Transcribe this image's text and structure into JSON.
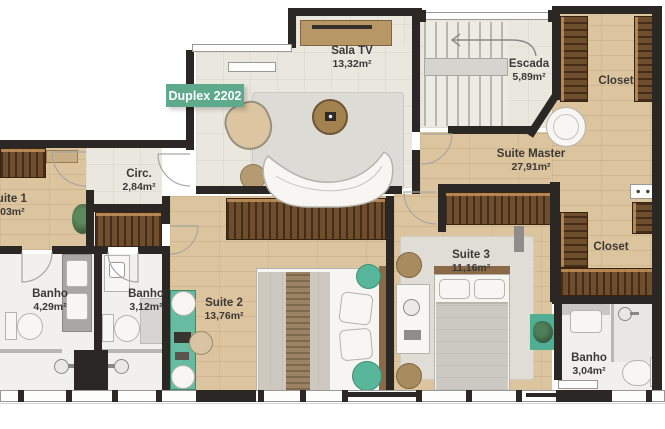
{
  "badge": {
    "label": "Duplex 2202",
    "color": "#5fa98c"
  },
  "rooms": [
    {
      "id": "sala-tv",
      "name": "Sala TV",
      "area": "13,32m²"
    },
    {
      "id": "escada",
      "name": "Escada",
      "area": "5,89m²"
    },
    {
      "id": "closet-top",
      "name": "Closet",
      "area": ""
    },
    {
      "id": "suite-master",
      "name": "Suite Master",
      "area": "27,91m²"
    },
    {
      "id": "circ",
      "name": "Circ.",
      "area": "2,84m²"
    },
    {
      "id": "suite-1",
      "name": "Suite 1",
      "area": "8,03m²"
    },
    {
      "id": "banho-1",
      "name": "Banho",
      "area": "4,29m²"
    },
    {
      "id": "banho-2",
      "name": "Banho",
      "area": "3,12m²"
    },
    {
      "id": "suite-2",
      "name": "Suite 2",
      "area": "13,76m²"
    },
    {
      "id": "suite-3",
      "name": "Suite 3",
      "area": "11,16m²"
    },
    {
      "id": "closet-right",
      "name": "Closet",
      "area": ""
    },
    {
      "id": "banho-3",
      "name": "Banho",
      "area": "3,04m²"
    }
  ],
  "icons": {
    "camera": "camera-icon",
    "plants": "plant-icon",
    "stairs_arrow": "stairs-direction-arrow",
    "shower": "shower-head-icon"
  },
  "colors": {
    "wall": "#2b2725",
    "wood_floor": "#dcc59e",
    "wardrobe_wood": "#6f4e2e",
    "badge_green": "#5fa98c",
    "accent_green": "#58b79b",
    "desk_green": "#66bba0"
  }
}
